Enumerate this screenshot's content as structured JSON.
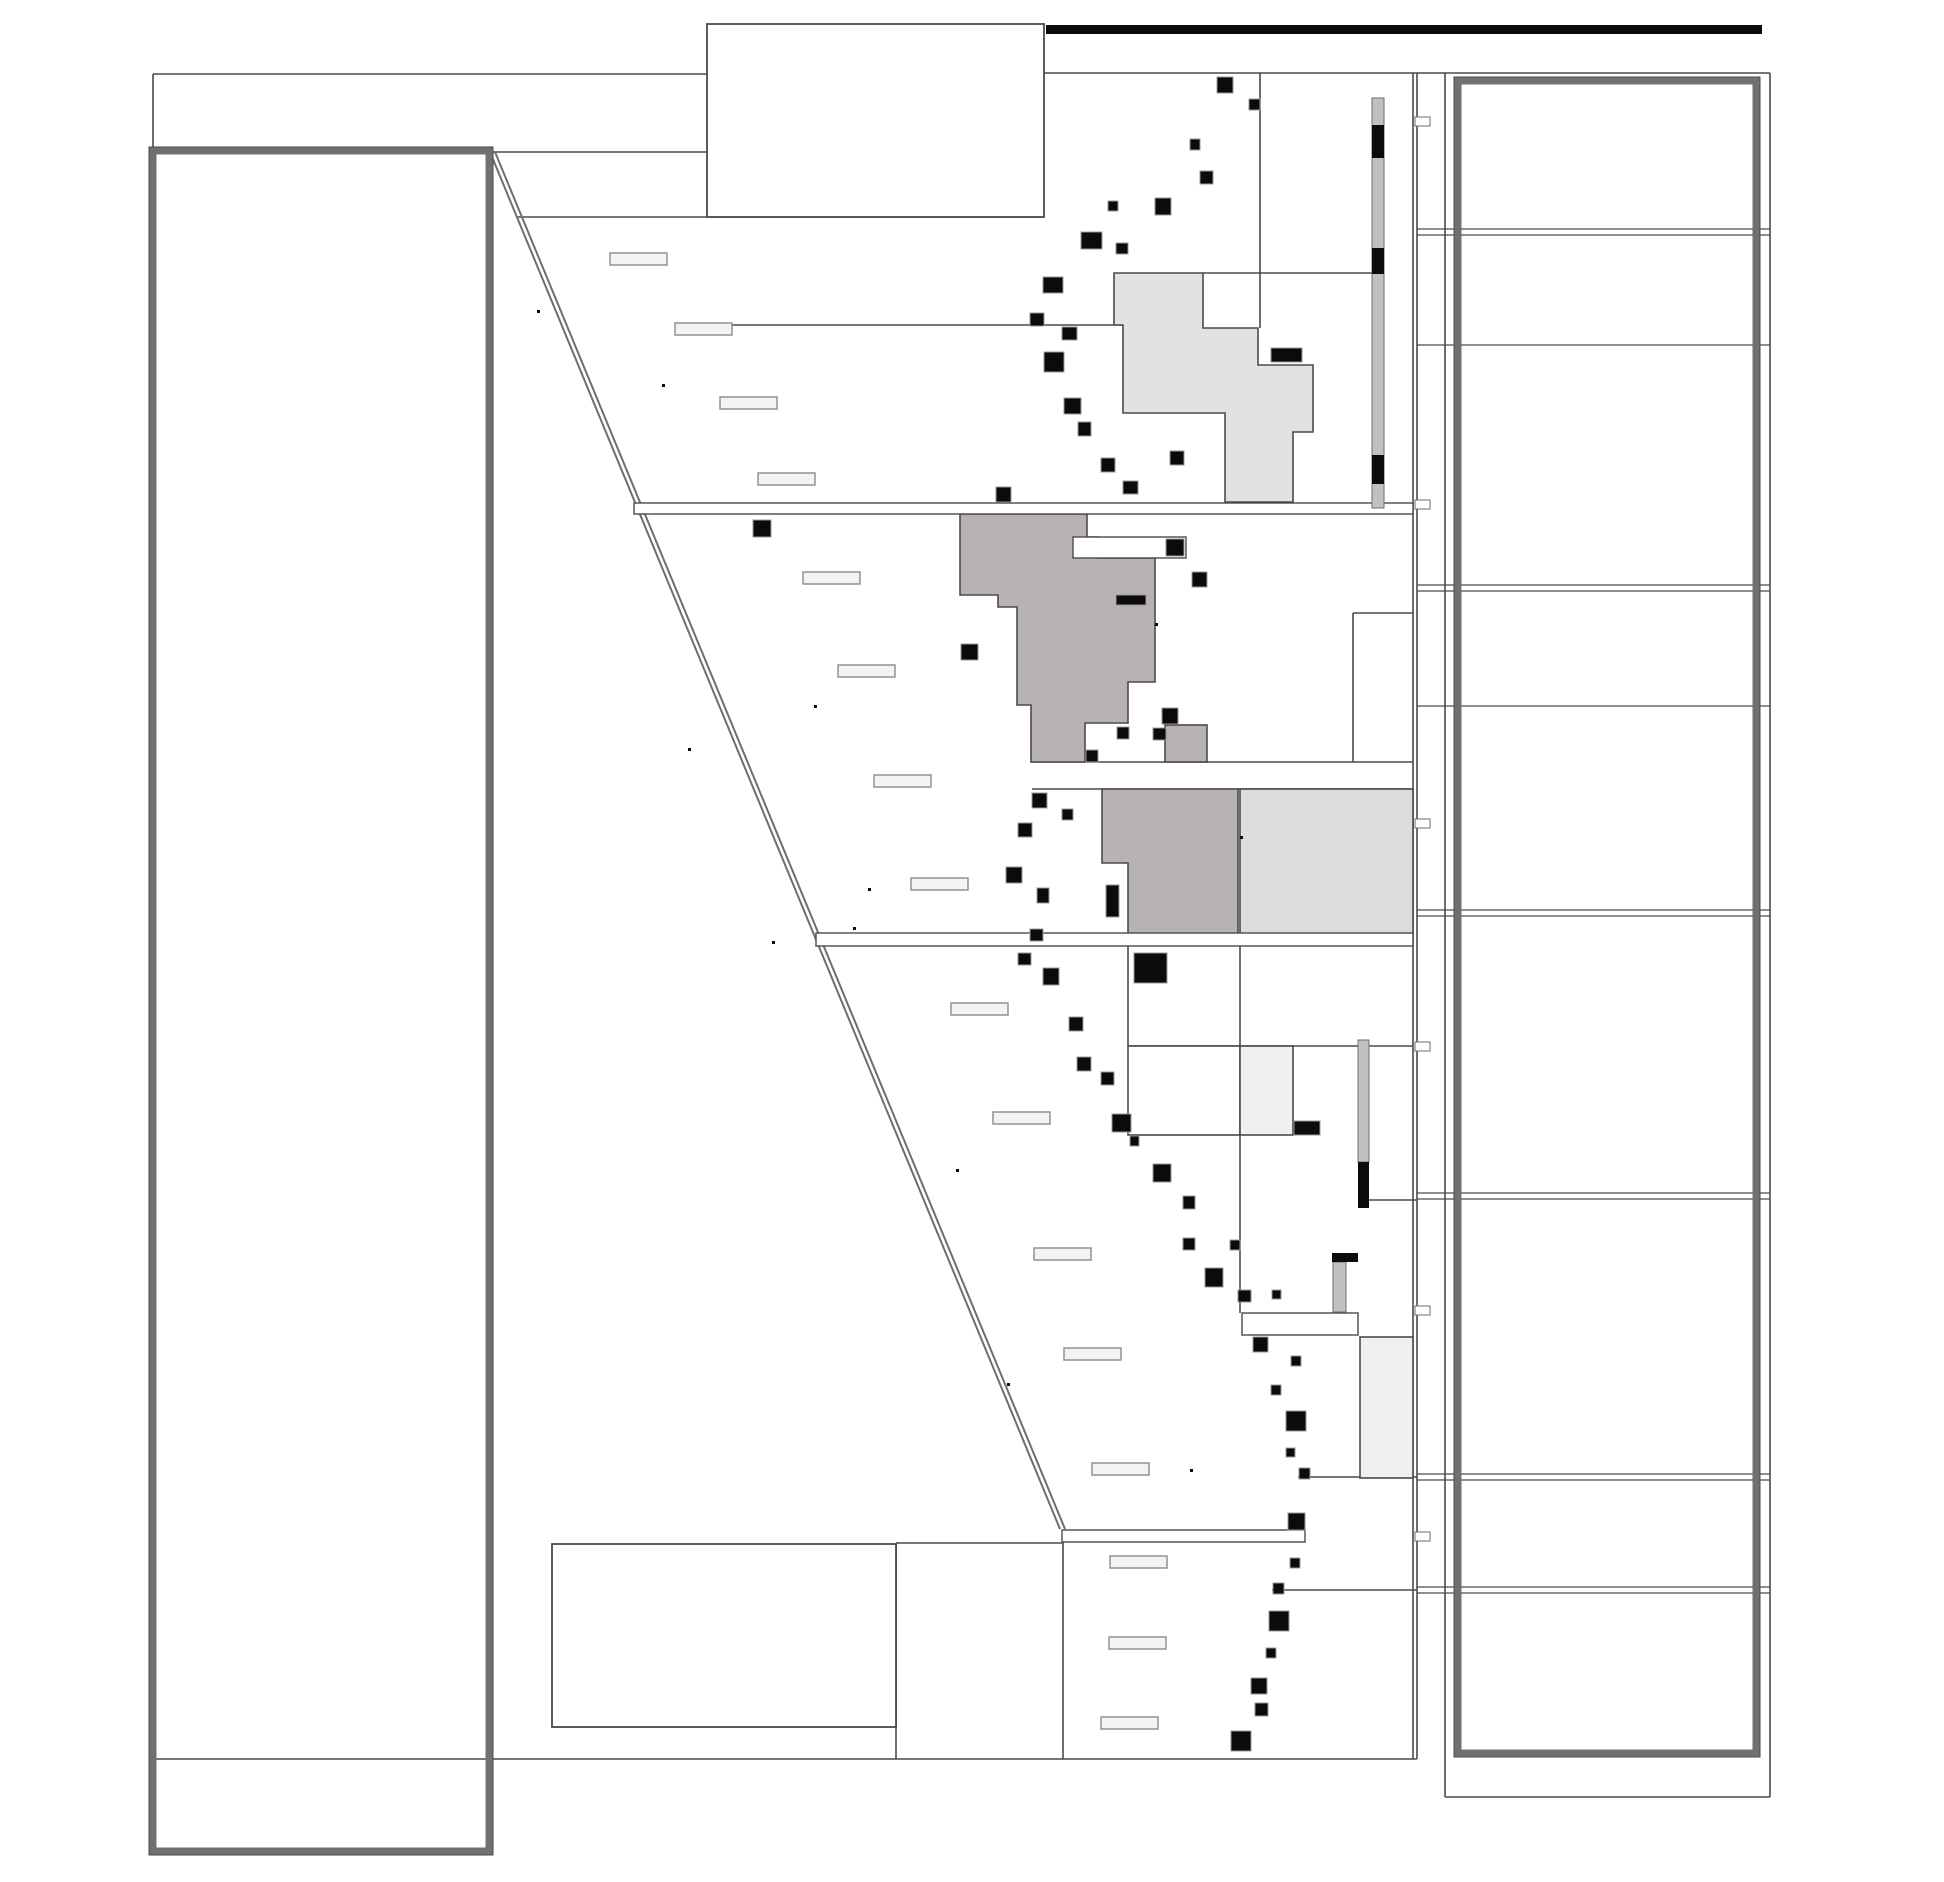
{
  "canvas": {
    "width": 1944,
    "height": 1882
  },
  "colors": {
    "line": "#4a4a4a",
    "line_soft": "#6e6e6e",
    "thick_frame": "#707070",
    "black": "#0b0b0b",
    "square_halo": "#9a9a9a",
    "taupe": "#b9b2b2",
    "light_gray": "#e2e2e2",
    "pale_gray": "#dcdcdc",
    "paler_gray": "#efefef",
    "box_gray": "#f0f0f0",
    "label_fill": "#f3f3f3",
    "label_border": "#8a8a8a",
    "strip_gray": "#c4c0c0",
    "white": "#ffffff"
  },
  "frames": {
    "left_thick_box": {
      "x": 153,
      "y": 151,
      "w": 336,
      "h": 1700,
      "stroke_w": 7
    },
    "right_thick_box": {
      "x": 1458,
      "y": 81,
      "w": 298,
      "h": 1672,
      "stroke_w": 7
    },
    "title_box": {
      "x": 707,
      "y": 24,
      "w": 337,
      "h": 193
    },
    "bottom_box": {
      "x": 552,
      "y": 1544,
      "w": 344,
      "h": 183
    },
    "top_black_bar": {
      "x": 1046,
      "y": 25,
      "w": 716,
      "h": 9
    }
  },
  "diagonal_lines": [
    [
      490,
      152,
      1060,
      1529
    ],
    [
      495,
      152,
      1065,
      1529
    ]
  ],
  "lines": [
    {
      "n": "frame-top-left",
      "p": [
        153,
        74,
        707,
        74
      ]
    },
    {
      "n": "frame-top-right",
      "p": [
        1044,
        73,
        1770,
        73
      ]
    },
    {
      "n": "frame-left-stub",
      "p": [
        153,
        74,
        153,
        150
      ]
    },
    {
      "n": "frame-bottom",
      "p": [
        152,
        1759,
        1417,
        1759
      ]
    },
    {
      "n": "boundary-right-a",
      "p": [
        1413,
        73,
        1413,
        1759
      ]
    },
    {
      "n": "boundary-right-b",
      "p": [
        1417,
        73,
        1417,
        1759
      ]
    },
    {
      "n": "ledge-y152",
      "p": [
        486,
        152,
        707,
        152
      ]
    },
    {
      "n": "section-y217",
      "p": [
        516,
        217,
        1044,
        217
      ]
    },
    {
      "n": "leader-y325",
      "p": [
        730,
        325,
        1123,
        325
      ]
    },
    {
      "n": "ledge-y273",
      "p": [
        1203,
        273,
        1372,
        273
      ]
    },
    {
      "n": "vert-1260",
      "p": [
        1260,
        73,
        1260,
        328
      ]
    },
    {
      "n": "section-y613",
      "p": [
        1353,
        613,
        1413,
        613
      ]
    },
    {
      "n": "vert-1353",
      "p": [
        1353,
        613,
        1353,
        762
      ]
    },
    {
      "n": "section-y762",
      "p": [
        1031,
        762,
        1413,
        762
      ]
    },
    {
      "n": "section-y789",
      "p": [
        1032,
        789,
        1413,
        789
      ]
    },
    {
      "n": "vert-1128",
      "p": [
        1128,
        946,
        1128,
        1046
      ]
    },
    {
      "n": "section-y1046",
      "p": [
        1128,
        1046,
        1413,
        1046
      ]
    },
    {
      "n": "vert-1240",
      "p": [
        1240,
        946,
        1240,
        1313
      ]
    },
    {
      "n": "stub-y1200",
      "p": [
        1358,
        1200,
        1417,
        1200
      ]
    },
    {
      "n": "stub-y1477",
      "p": [
        1298,
        1477,
        1417,
        1477
      ]
    },
    {
      "n": "stub-y1590",
      "p": [
        1272,
        1590,
        1417,
        1590
      ]
    },
    {
      "n": "bench-y1543",
      "p": [
        896,
        1543,
        1062,
        1543
      ]
    },
    {
      "n": "vert-896",
      "p": [
        896,
        1544,
        896,
        1759
      ]
    },
    {
      "n": "vert-1063",
      "p": [
        1063,
        1542,
        1063,
        1759
      ]
    },
    {
      "n": "panel-v-1445",
      "p": [
        1445,
        73,
        1445,
        1797
      ]
    },
    {
      "n": "panel-v-1770",
      "p": [
        1770,
        73,
        1770,
        1797
      ]
    },
    {
      "n": "panel-bottom",
      "p": [
        1445,
        1797,
        1770,
        1797
      ]
    }
  ],
  "panel_rows": {
    "x1": 1417,
    "x2": 1770,
    "double_y": [
      [
        229,
        235
      ],
      [
        585,
        591
      ],
      [
        910,
        916
      ],
      [
        1193,
        1199
      ],
      [
        1474,
        1480
      ],
      [
        1587,
        1593
      ]
    ],
    "single_y": [
      345,
      706
    ]
  },
  "white_bars": [
    {
      "n": "marker-bar-y503",
      "x": 634,
      "y": 503,
      "w": 779,
      "h": 11
    },
    {
      "n": "marker-bar-y933",
      "x": 816,
      "y": 933,
      "w": 597,
      "h": 13
    },
    {
      "n": "marker-bar-y1530",
      "x": 1062,
      "y": 1530,
      "w": 243,
      "h": 12
    },
    {
      "n": "inset-bar-w0",
      "x": 1073,
      "y": 537,
      "w": 113,
      "h": 21
    },
    {
      "n": "inset-bar-w1",
      "x": 1242,
      "y": 1313,
      "w": 116,
      "h": 22
    }
  ],
  "fill_boxes": [
    {
      "n": "cell-box-a",
      "x": 1128,
      "y": 1046,
      "w": 112,
      "h": 89,
      "fill": "white"
    },
    {
      "n": "cell-box-b",
      "x": 1240,
      "y": 1046,
      "w": 53,
      "h": 89,
      "fill": "box_gray"
    },
    {
      "n": "cell-box-g1",
      "x": 1360,
      "y": 1337,
      "w": 53,
      "h": 141,
      "fill": "paler_gray"
    },
    {
      "n": "lith-rect-r3",
      "x": 1240,
      "y": 789,
      "w": 173,
      "h": 151,
      "fill": "pale_gray"
    },
    {
      "n": "lith-rect-small",
      "x": 1165,
      "y": 725,
      "w": 42,
      "h": 37,
      "fill": "taupe"
    }
  ],
  "polygons": [
    {
      "n": "lithology-polygon-upper",
      "fill": "light_gray",
      "d": "M1114,273 L1203,273 L1203,328 L1258,328 L1258,365 L1313,365 L1313,432 L1293,432 L1293,502 L1225,502 L1225,413 L1123,413 L1123,325 L1114,325 Z"
    },
    {
      "n": "lithology-polygon-main",
      "fill": "taupe",
      "d": "M960,514 L1087,514 L1087,537 L1098,537 L1098,558 L1155,558 L1155,682 L1128,682 L1128,723 L1085,723 L1085,762 L1031,762 L1031,705 L1017,705 L1017,607 L998,607 L998,595 L960,595 Z"
    },
    {
      "n": "lithology-polygon-r2",
      "fill": "taupe",
      "d": "M1102,789 L1238,789 L1238,940 L1128,940 L1128,863 L1102,863 Z"
    }
  ],
  "strips": [
    {
      "n": "gray-strip-top",
      "x": 1372,
      "y": 98,
      "w": 12,
      "h": 410,
      "blacks": [
        [
          1372,
          125,
          12,
          33
        ],
        [
          1372,
          248,
          12,
          26
        ],
        [
          1372,
          455,
          12,
          29
        ]
      ]
    },
    {
      "n": "gray-strip-mid",
      "x": 1358,
      "y": 1040,
      "w": 11,
      "h": 122,
      "blacks": [
        [
          1358,
          1162,
          11,
          46
        ]
      ]
    },
    {
      "n": "gray-strip-low",
      "x": 1333,
      "y": 1262,
      "w": 13,
      "h": 50,
      "blacks": [
        [
          1332,
          1253,
          26,
          9
        ]
      ]
    }
  ],
  "ticks": [
    [
      1415,
      117,
      15,
      9
    ],
    [
      1415,
      500,
      15,
      9
    ],
    [
      1415,
      819,
      15,
      9
    ],
    [
      1415,
      1042,
      15,
      9
    ],
    [
      1415,
      1306,
      15,
      9
    ],
    [
      1415,
      1532,
      15,
      9
    ]
  ],
  "labels": [
    [
      610,
      253
    ],
    [
      675,
      323
    ],
    [
      720,
      397
    ],
    [
      758,
      473
    ],
    [
      803,
      572
    ],
    [
      838,
      665
    ],
    [
      874,
      775
    ],
    [
      911,
      878
    ],
    [
      951,
      1003
    ],
    [
      993,
      1112
    ],
    [
      1034,
      1248
    ],
    [
      1064,
      1348
    ],
    [
      1092,
      1463
    ],
    [
      1110,
      1556
    ],
    [
      1109,
      1637
    ],
    [
      1101,
      1717
    ]
  ],
  "label_size": {
    "w": 57,
    "h": 12
  },
  "squares": [
    [
      1217,
      77,
      16,
      16
    ],
    [
      1249,
      99,
      11,
      11
    ],
    [
      1190,
      139,
      10,
      11
    ],
    [
      1200,
      171,
      13,
      13
    ],
    [
      1155,
      198,
      16,
      17
    ],
    [
      1108,
      201,
      10,
      10
    ],
    [
      1116,
      243,
      12,
      11
    ],
    [
      1081,
      232,
      21,
      17
    ],
    [
      1043,
      277,
      20,
      16
    ],
    [
      1030,
      313,
      14,
      13
    ],
    [
      1062,
      327,
      15,
      13
    ],
    [
      1044,
      352,
      20,
      20
    ],
    [
      1064,
      398,
      17,
      16
    ],
    [
      1078,
      422,
      13,
      14
    ],
    [
      1101,
      458,
      14,
      14
    ],
    [
      1170,
      451,
      14,
      14
    ],
    [
      1123,
      481,
      15,
      13
    ],
    [
      996,
      487,
      15,
      15
    ],
    [
      753,
      520,
      18,
      17
    ],
    [
      1192,
      572,
      15,
      15
    ],
    [
      961,
      644,
      17,
      16
    ],
    [
      1271,
      348,
      31,
      14
    ],
    [
      1162,
      708,
      16,
      16
    ],
    [
      1117,
      727,
      12,
      12
    ],
    [
      1153,
      728,
      13,
      12
    ],
    [
      1086,
      750,
      12,
      12
    ],
    [
      1032,
      793,
      15,
      15
    ],
    [
      1062,
      809,
      11,
      11
    ],
    [
      1018,
      823,
      14,
      14
    ],
    [
      1006,
      867,
      16,
      16
    ],
    [
      1037,
      888,
      12,
      15
    ],
    [
      1030,
      929,
      13,
      12
    ],
    [
      1018,
      953,
      13,
      12
    ],
    [
      1134,
      953,
      33,
      30
    ],
    [
      1106,
      885,
      13,
      32
    ],
    [
      1043,
      968,
      16,
      17
    ],
    [
      1069,
      1017,
      14,
      14
    ],
    [
      1077,
      1057,
      14,
      14
    ],
    [
      1101,
      1072,
      13,
      13
    ],
    [
      1112,
      1114,
      19,
      18
    ],
    [
      1130,
      1136,
      9,
      10
    ],
    [
      1153,
      1164,
      18,
      18
    ],
    [
      1183,
      1196,
      12,
      13
    ],
    [
      1183,
      1238,
      12,
      12
    ],
    [
      1230,
      1240,
      10,
      10
    ],
    [
      1205,
      1268,
      18,
      19
    ],
    [
      1238,
      1290,
      13,
      12
    ],
    [
      1272,
      1290,
      9,
      9
    ],
    [
      1294,
      1121,
      26,
      14
    ],
    [
      1253,
      1337,
      15,
      15
    ],
    [
      1291,
      1356,
      10,
      10
    ],
    [
      1271,
      1385,
      10,
      10
    ],
    [
      1286,
      1411,
      20,
      20
    ],
    [
      1286,
      1448,
      9,
      9
    ],
    [
      1299,
      1468,
      11,
      11
    ],
    [
      1288,
      1513,
      17,
      17
    ],
    [
      1290,
      1558,
      10,
      10
    ],
    [
      1273,
      1583,
      11,
      11
    ],
    [
      1269,
      1611,
      20,
      20
    ],
    [
      1266,
      1648,
      10,
      10
    ],
    [
      1251,
      1678,
      16,
      16
    ],
    [
      1255,
      1703,
      13,
      13
    ],
    [
      1231,
      1731,
      20,
      20
    ],
    [
      1166,
      539,
      18,
      17
    ],
    [
      1116,
      595,
      30,
      10
    ]
  ],
  "dots": [
    [
      537,
      310
    ],
    [
      662,
      384
    ],
    [
      814,
      705
    ],
    [
      688,
      748
    ],
    [
      868,
      888
    ],
    [
      853,
      927
    ],
    [
      772,
      941
    ],
    [
      956,
      1169
    ],
    [
      1240,
      836
    ],
    [
      1007,
      1383
    ],
    [
      1190,
      1469
    ],
    [
      1155,
      623
    ]
  ]
}
